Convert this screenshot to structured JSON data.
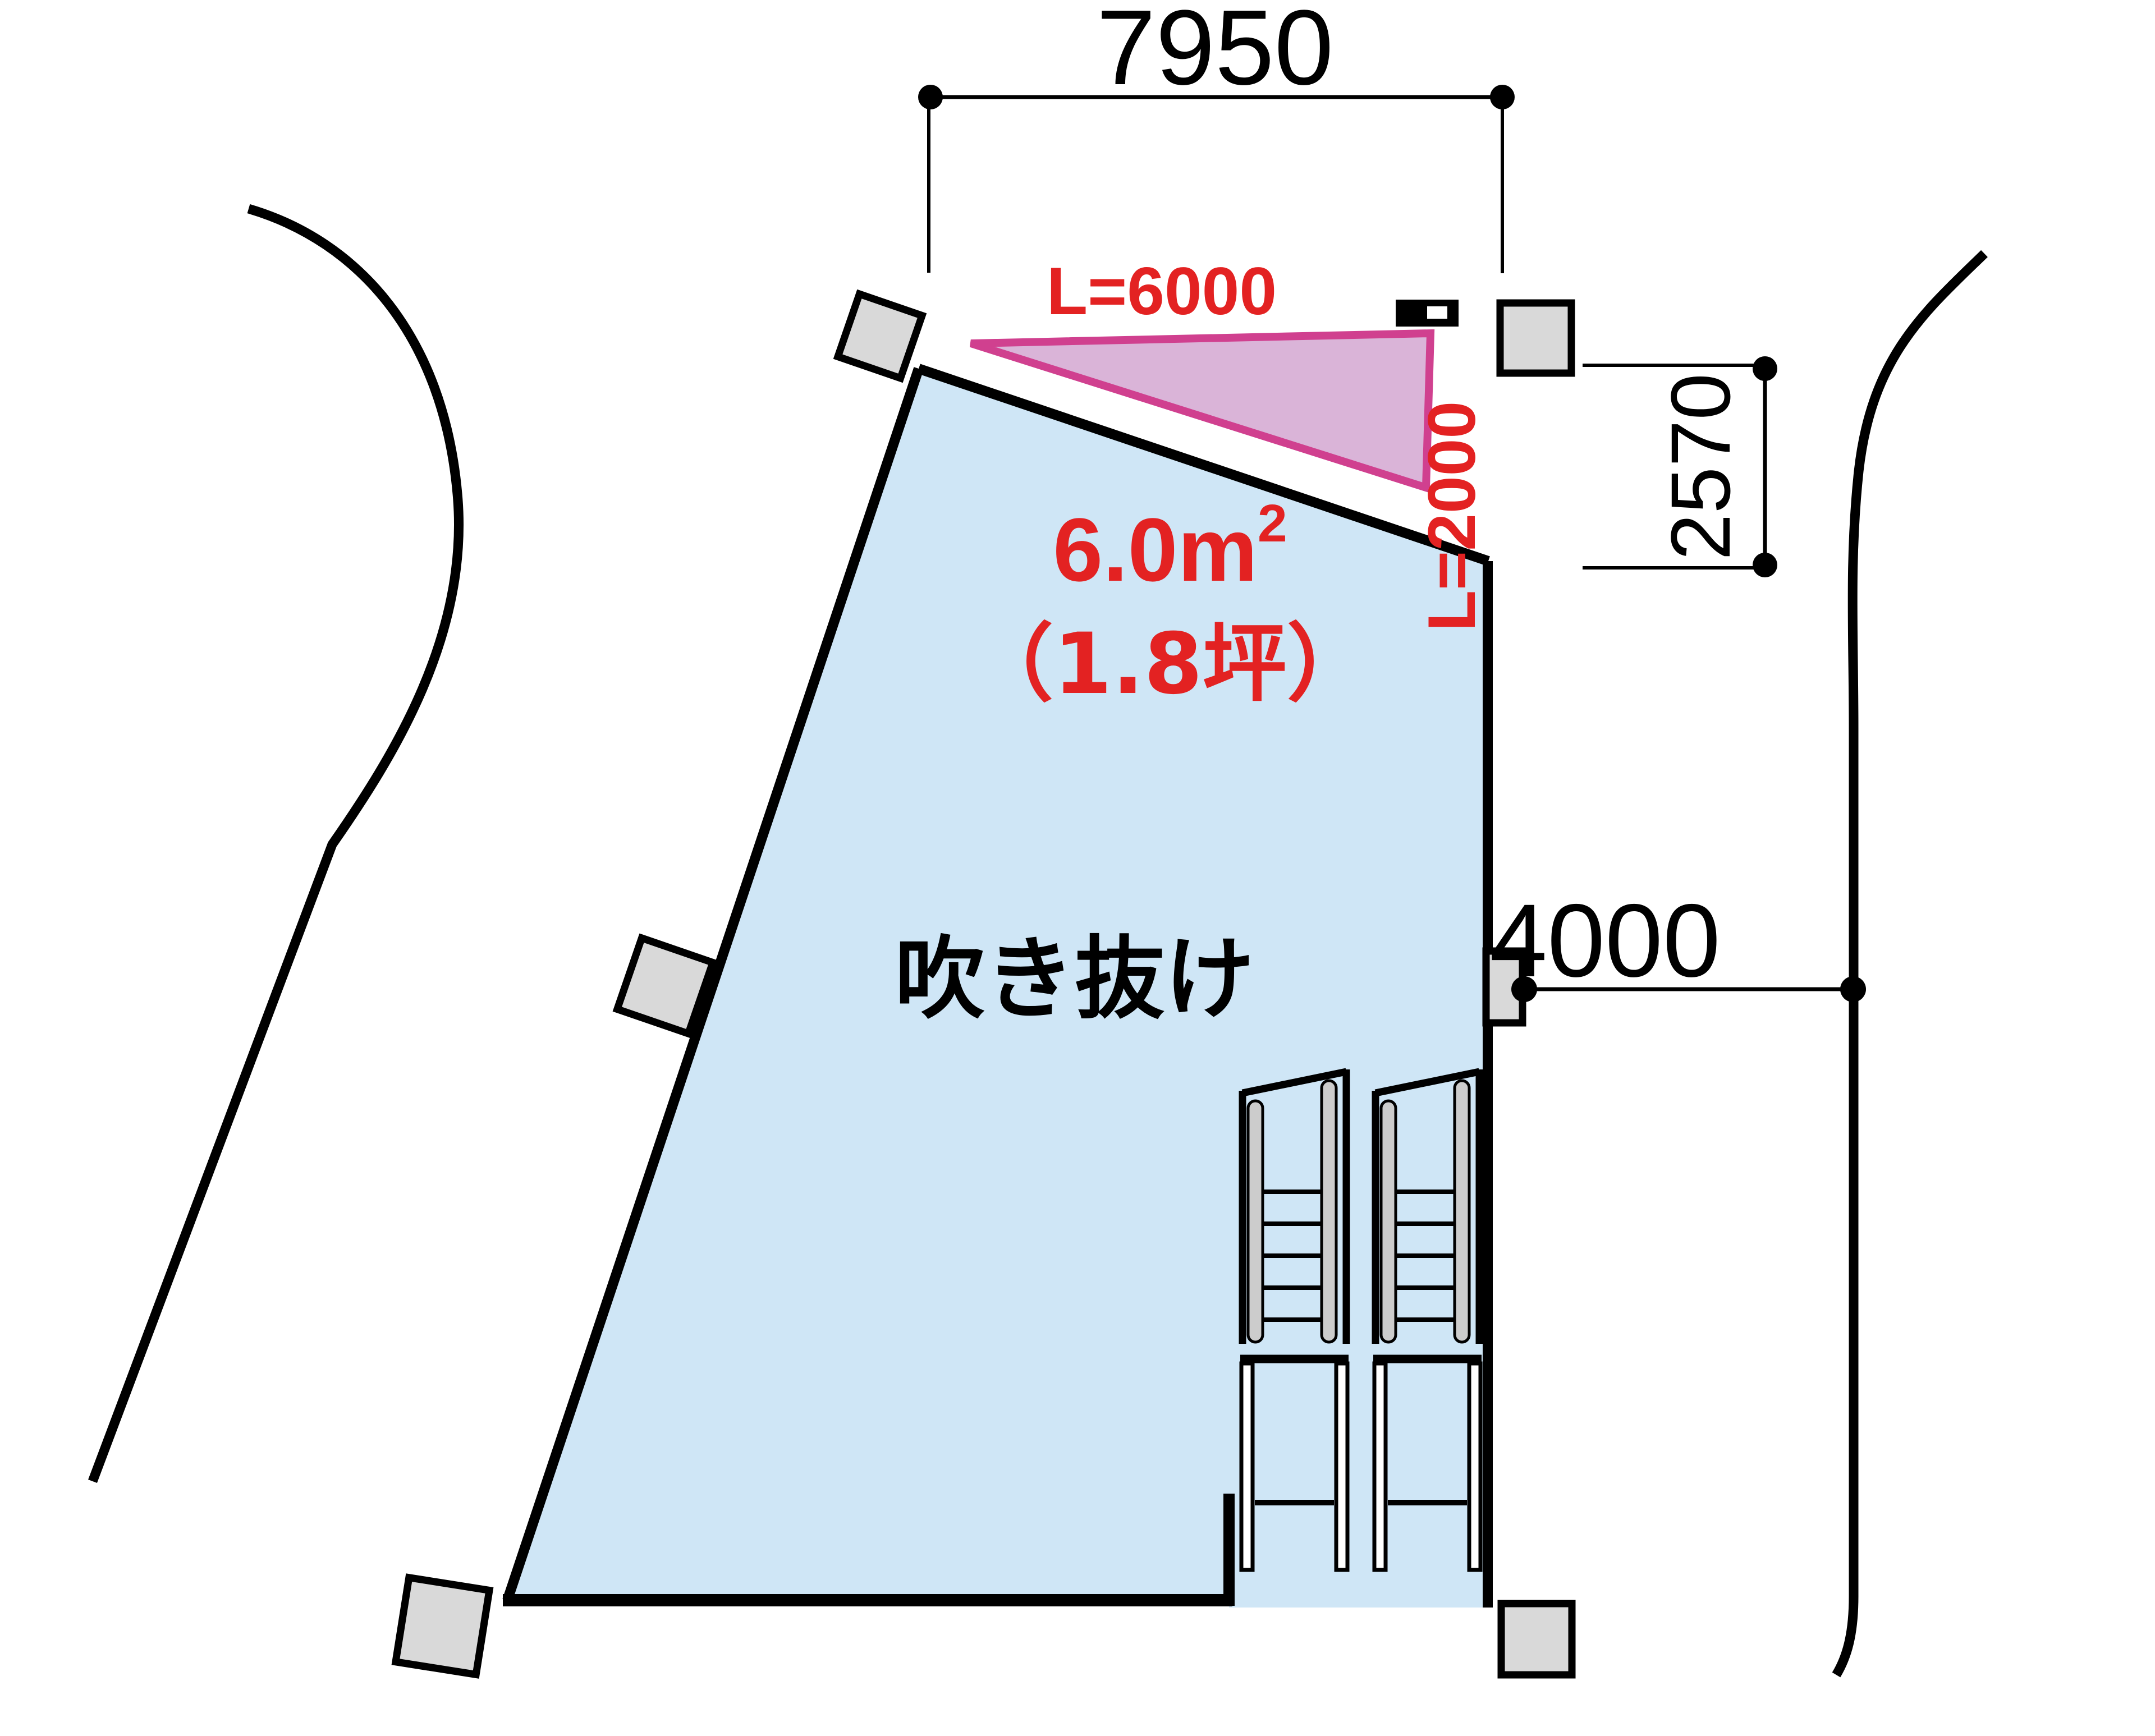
{
  "labels": {
    "dim_top": "7950",
    "dim_right_upper": "2570",
    "dim_right_lower": "4000",
    "louver_length": "L=6000",
    "louver_side": "L=2000",
    "area_value": "6.0m",
    "area_sup": "2",
    "area_tsubo": "（1.8坪）",
    "void_label": "吹き抜け"
  },
  "colors": {
    "void_fill": "#cfe6f6",
    "triangle_fill": "#dab4d8",
    "triangle_stroke": "#d0408f",
    "annotation_red": "#e32222",
    "column_fill": "#d9d9d9",
    "rail_gray": "#cccccc",
    "line_black": "#000000"
  }
}
